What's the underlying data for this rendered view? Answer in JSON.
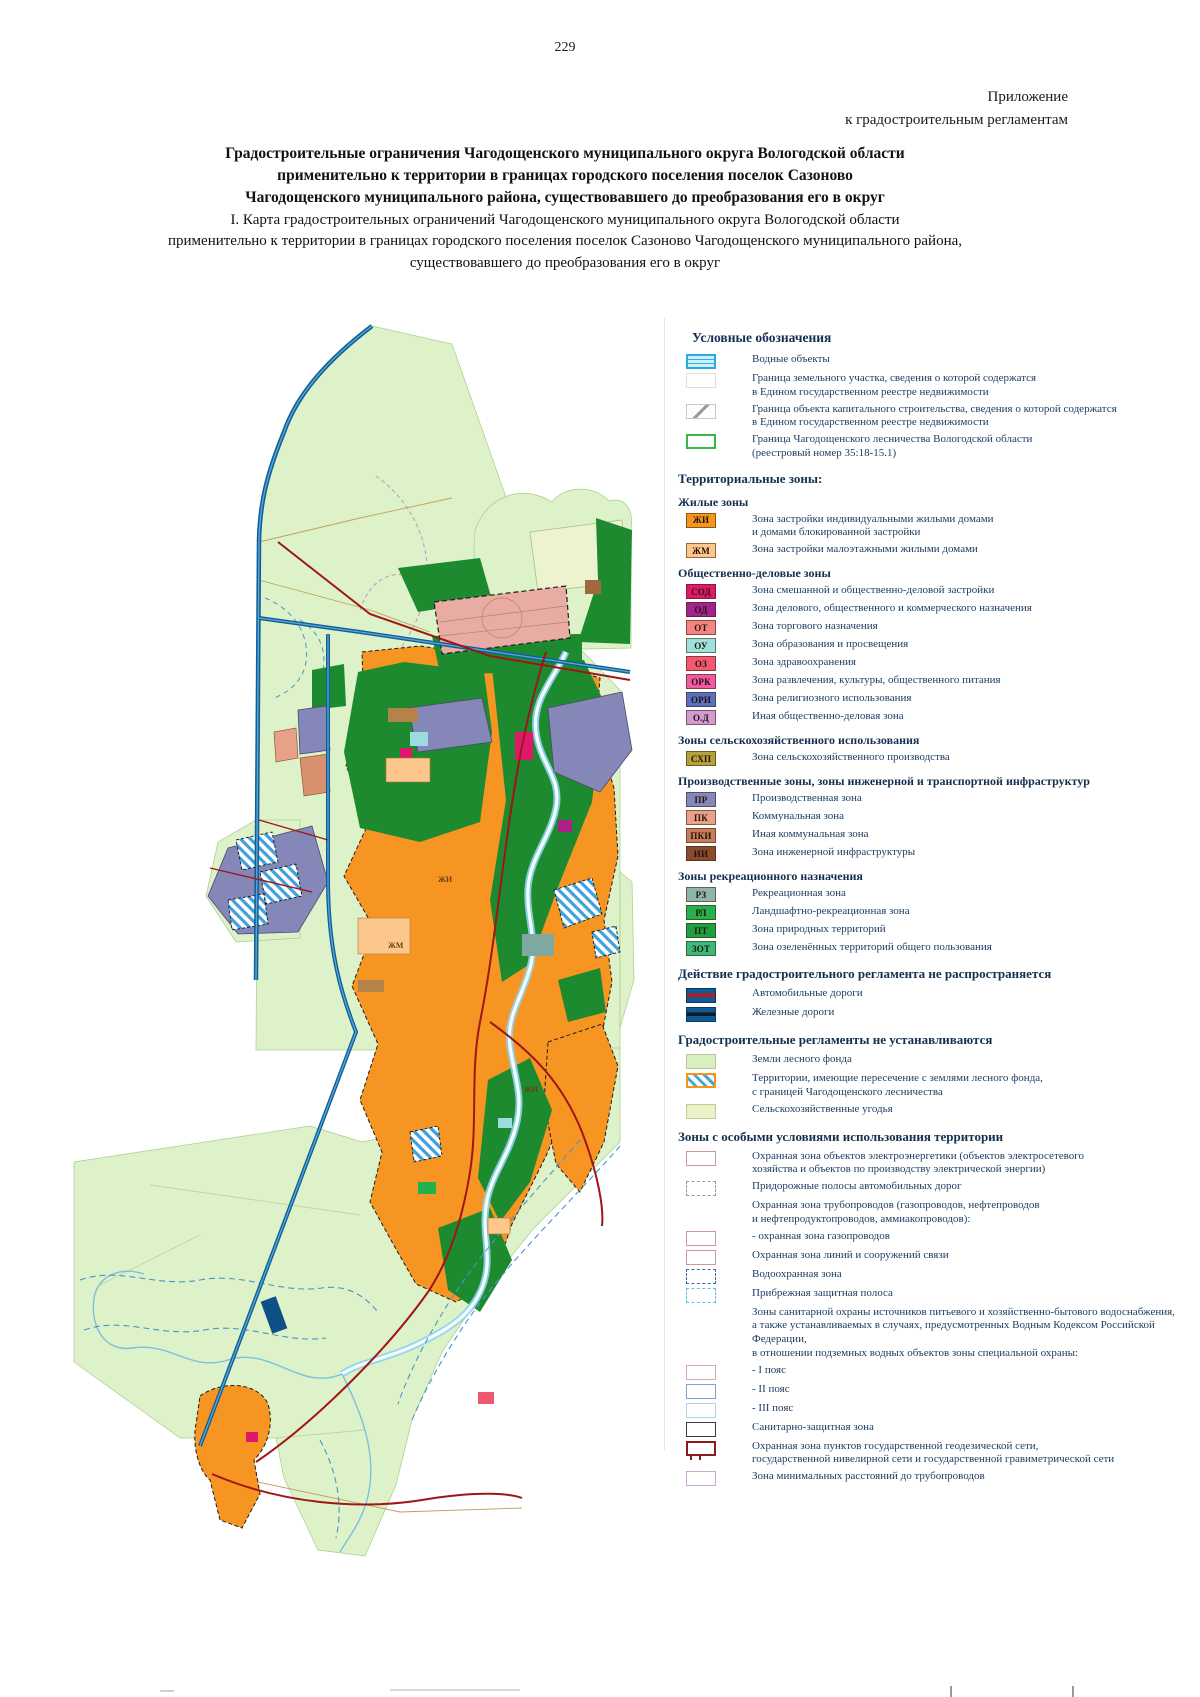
{
  "page": {
    "number": "229"
  },
  "annex": {
    "text": "Приложение\nк градостроительным регламентам"
  },
  "title": {
    "bold": "Градостроительные ограничения Чагодощенского муниципального округа Вологодской области\nприменительно к территории в границах городского поселения поселок Сазоново\nЧагодощенского муниципального района, существовавшего до преобразования его в округ",
    "sub": "I. Карта градостроительных ограничений Чагодощенского муниципального округа Вологодской области\nприменительно к территории в границах городского поселения поселок Сазоново Чагодощенского муниципального района,\nсуществовавшего до преобразования его в округ"
  },
  "colors": {
    "water_border": "#29abe2",
    "forest_green": "#1d8a30",
    "urban_orange": "#f79522",
    "railway_blue": "#0f5f96",
    "road_red": "#9e1616",
    "base_green": "#def2c9"
  },
  "map": {
    "labels": [
      "ЖИ",
      "ЖИ",
      "ЖМ"
    ]
  },
  "legend": {
    "title": "Условные обозначения",
    "simple": [
      {
        "label": "Водные объекты"
      },
      {
        "label": "Граница земельного участка, сведения о которой содержатся\nв Едином государственном реестре недвижимости"
      },
      {
        "label": "Граница объекта капитального строительства, сведения о которой содержатся\nв Едином государственном реестре недвижимости"
      },
      {
        "label": "Граница Чагодощенского лесничества Вологодской области\n(реестровый номер 35:18-15.1)"
      }
    ],
    "territorial_title": "Территориальные зоны:",
    "groups": [
      {
        "header": "Жилые зоны",
        "items": [
          {
            "code": "ЖИ",
            "color": "#f7941e",
            "label": "Зона застройки индивидуальными жилыми домами\nи домами блокированной застройки"
          },
          {
            "code": "ЖМ",
            "color": "#fdc68c",
            "label": "Зона застройки малоэтажными жилыми домами"
          }
        ]
      },
      {
        "header": "Общественно-деловые зоны",
        "items": [
          {
            "code": "СОД",
            "color": "#e0186c",
            "label": "Зона смешанной и общественно-деловой застройки"
          },
          {
            "code": "ОД",
            "color": "#a3238e",
            "label": "Зона делового, общественного и коммерческого назначения"
          },
          {
            "code": "ОТ",
            "color": "#f48484",
            "label": "Зона торгового назначения"
          },
          {
            "code": "ОУ",
            "color": "#9fe0dc",
            "label": "Зона образования и просвещения"
          },
          {
            "code": "ОЗ",
            "color": "#f25872",
            "label": "Зона здравоохранения"
          },
          {
            "code": "ОРК",
            "color": "#ef5ba1",
            "label": "Зона развлечения, культуры, общественного питания"
          },
          {
            "code": "ОРИ",
            "color": "#5b6fc0",
            "label": "Зона религиозного использования"
          },
          {
            "code": "О.Д",
            "color": "#d49ad4",
            "label": "Иная общественно-деловая зона"
          }
        ]
      },
      {
        "header": "Зоны сельскохозяйственного использования",
        "items": [
          {
            "code": "СХП",
            "color": "#b3a13c",
            "label": "Зона сельскохозяйственного производства"
          }
        ]
      },
      {
        "header": "Производственные зоны, зоны инженерной и транспортной инфраструктур",
        "items": [
          {
            "code": "ПР",
            "color": "#8587b8",
            "label": "Производственная зона"
          },
          {
            "code": "ПК",
            "color": "#e8a088",
            "label": "Коммунальная зона"
          },
          {
            "code": "ПКИ",
            "color": "#c87e5c",
            "label": "Иная коммунальная зона"
          },
          {
            "code": "ИИ",
            "color": "#8c4a2f",
            "label": "Зона инженерной инфраструктуры"
          }
        ]
      },
      {
        "header": "Зоны рекреационного назначения",
        "items": [
          {
            "code": "РЗ",
            "color": "#8fb4ac",
            "label": "Рекреационная зона"
          },
          {
            "code": "РЛ",
            "color": "#27b04e",
            "label": "Ландшафтно-рекреационная зона"
          },
          {
            "code": "ПТ",
            "color": "#1f9e42",
            "label": "Зона природных территорий"
          },
          {
            "code": "ЗОТ",
            "color": "#3cb878",
            "label": "Зона озеленённых территорий общего пользования"
          }
        ]
      }
    ],
    "sections": [
      {
        "header": "Действие градостроительного регламента не распространяется",
        "items": [
          {
            "label": "Автомобильные дороги"
          },
          {
            "label": "Железные дороги"
          }
        ]
      },
      {
        "header": "Градостроительные регламенты не устанавливаются",
        "items": [
          {
            "label": "Земли лесного фонда"
          },
          {
            "label": "Территории, имеющие пересечение с землями лесного фонда,\nс границей Чагодощенского лесничества"
          },
          {
            "label": "Сельскохозяйственные угодья"
          }
        ]
      },
      {
        "header": "Зоны с особыми условиями использования территории",
        "items": [
          {
            "label": "Охранная зона объектов электроэнергетики (объектов электросетевого\nхозяйства и объектов по производству электрической энергии)"
          },
          {
            "label": "Придорожные полосы автомобильных дорог"
          },
          {
            "label": "Охранная зона трубопроводов (газопроводов, нефтепроводов\nи нефтепродуктопроводов, аммиакопроводов):"
          },
          {
            "label": "- охранная зона газопроводов"
          },
          {
            "label": "Охранная зона линий и сооружений связи"
          },
          {
            "label": "Водоохранная зона"
          },
          {
            "label": "Прибрежная защитная полоса"
          },
          {
            "label": "Зоны санитарной охраны источников питьевого и хозяйственно-бытового водоснабжения,\nа также устанавливаемых в случаях, предусмотренных Водным Кодексом Российской Федерации,\nв отношении подземных водных объектов зоны специальной охраны:"
          },
          {
            "label": "- I пояс"
          },
          {
            "label": "- II пояс"
          },
          {
            "label": "- III пояс"
          },
          {
            "label": "Санитарно-защитная зона"
          },
          {
            "label": "Охранная зона пунктов государственной геодезической сети,\nгосударственной нивелирной сети и государственной гравиметрической сети"
          },
          {
            "label": "Зона минимальных расстояний до трубопроводов"
          }
        ]
      }
    ]
  }
}
